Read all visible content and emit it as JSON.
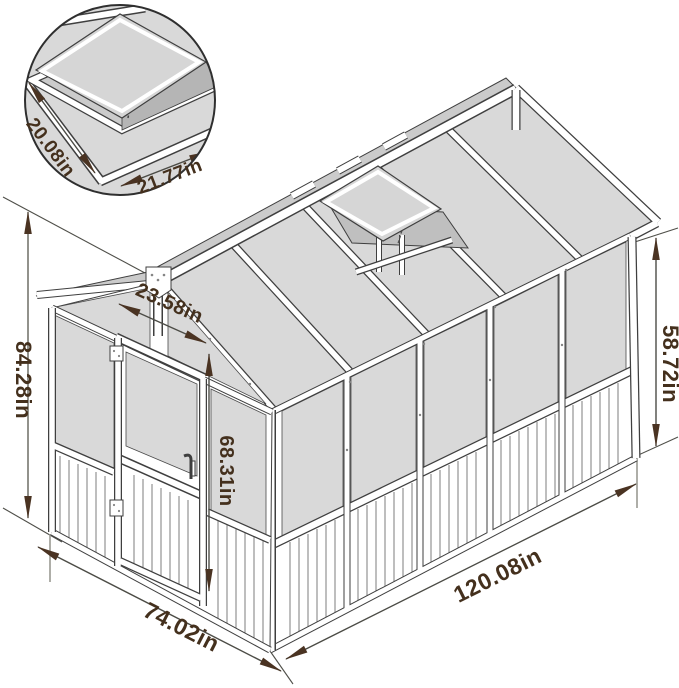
{
  "inset": {
    "vent_width_label": "20.08in",
    "vent_depth_label": "21.77in"
  },
  "labels": {
    "overall_height": "84.28in",
    "door_width": "23.58in",
    "door_height": "68.31in",
    "wall_height": "58.72in",
    "length": "120.08in",
    "depth": "74.02in"
  },
  "colors": {
    "line": "#3f3f3f",
    "panel": "#d9d9d9",
    "panel_shade": "#cbcbcb",
    "vent_opening": "#bfbfbf",
    "lid": "#d6d6d6",
    "dim_text": "#44301d",
    "arrow": "#4a3322",
    "dim_line": "#4c4c46",
    "ext_gray": "#9a9a92"
  }
}
